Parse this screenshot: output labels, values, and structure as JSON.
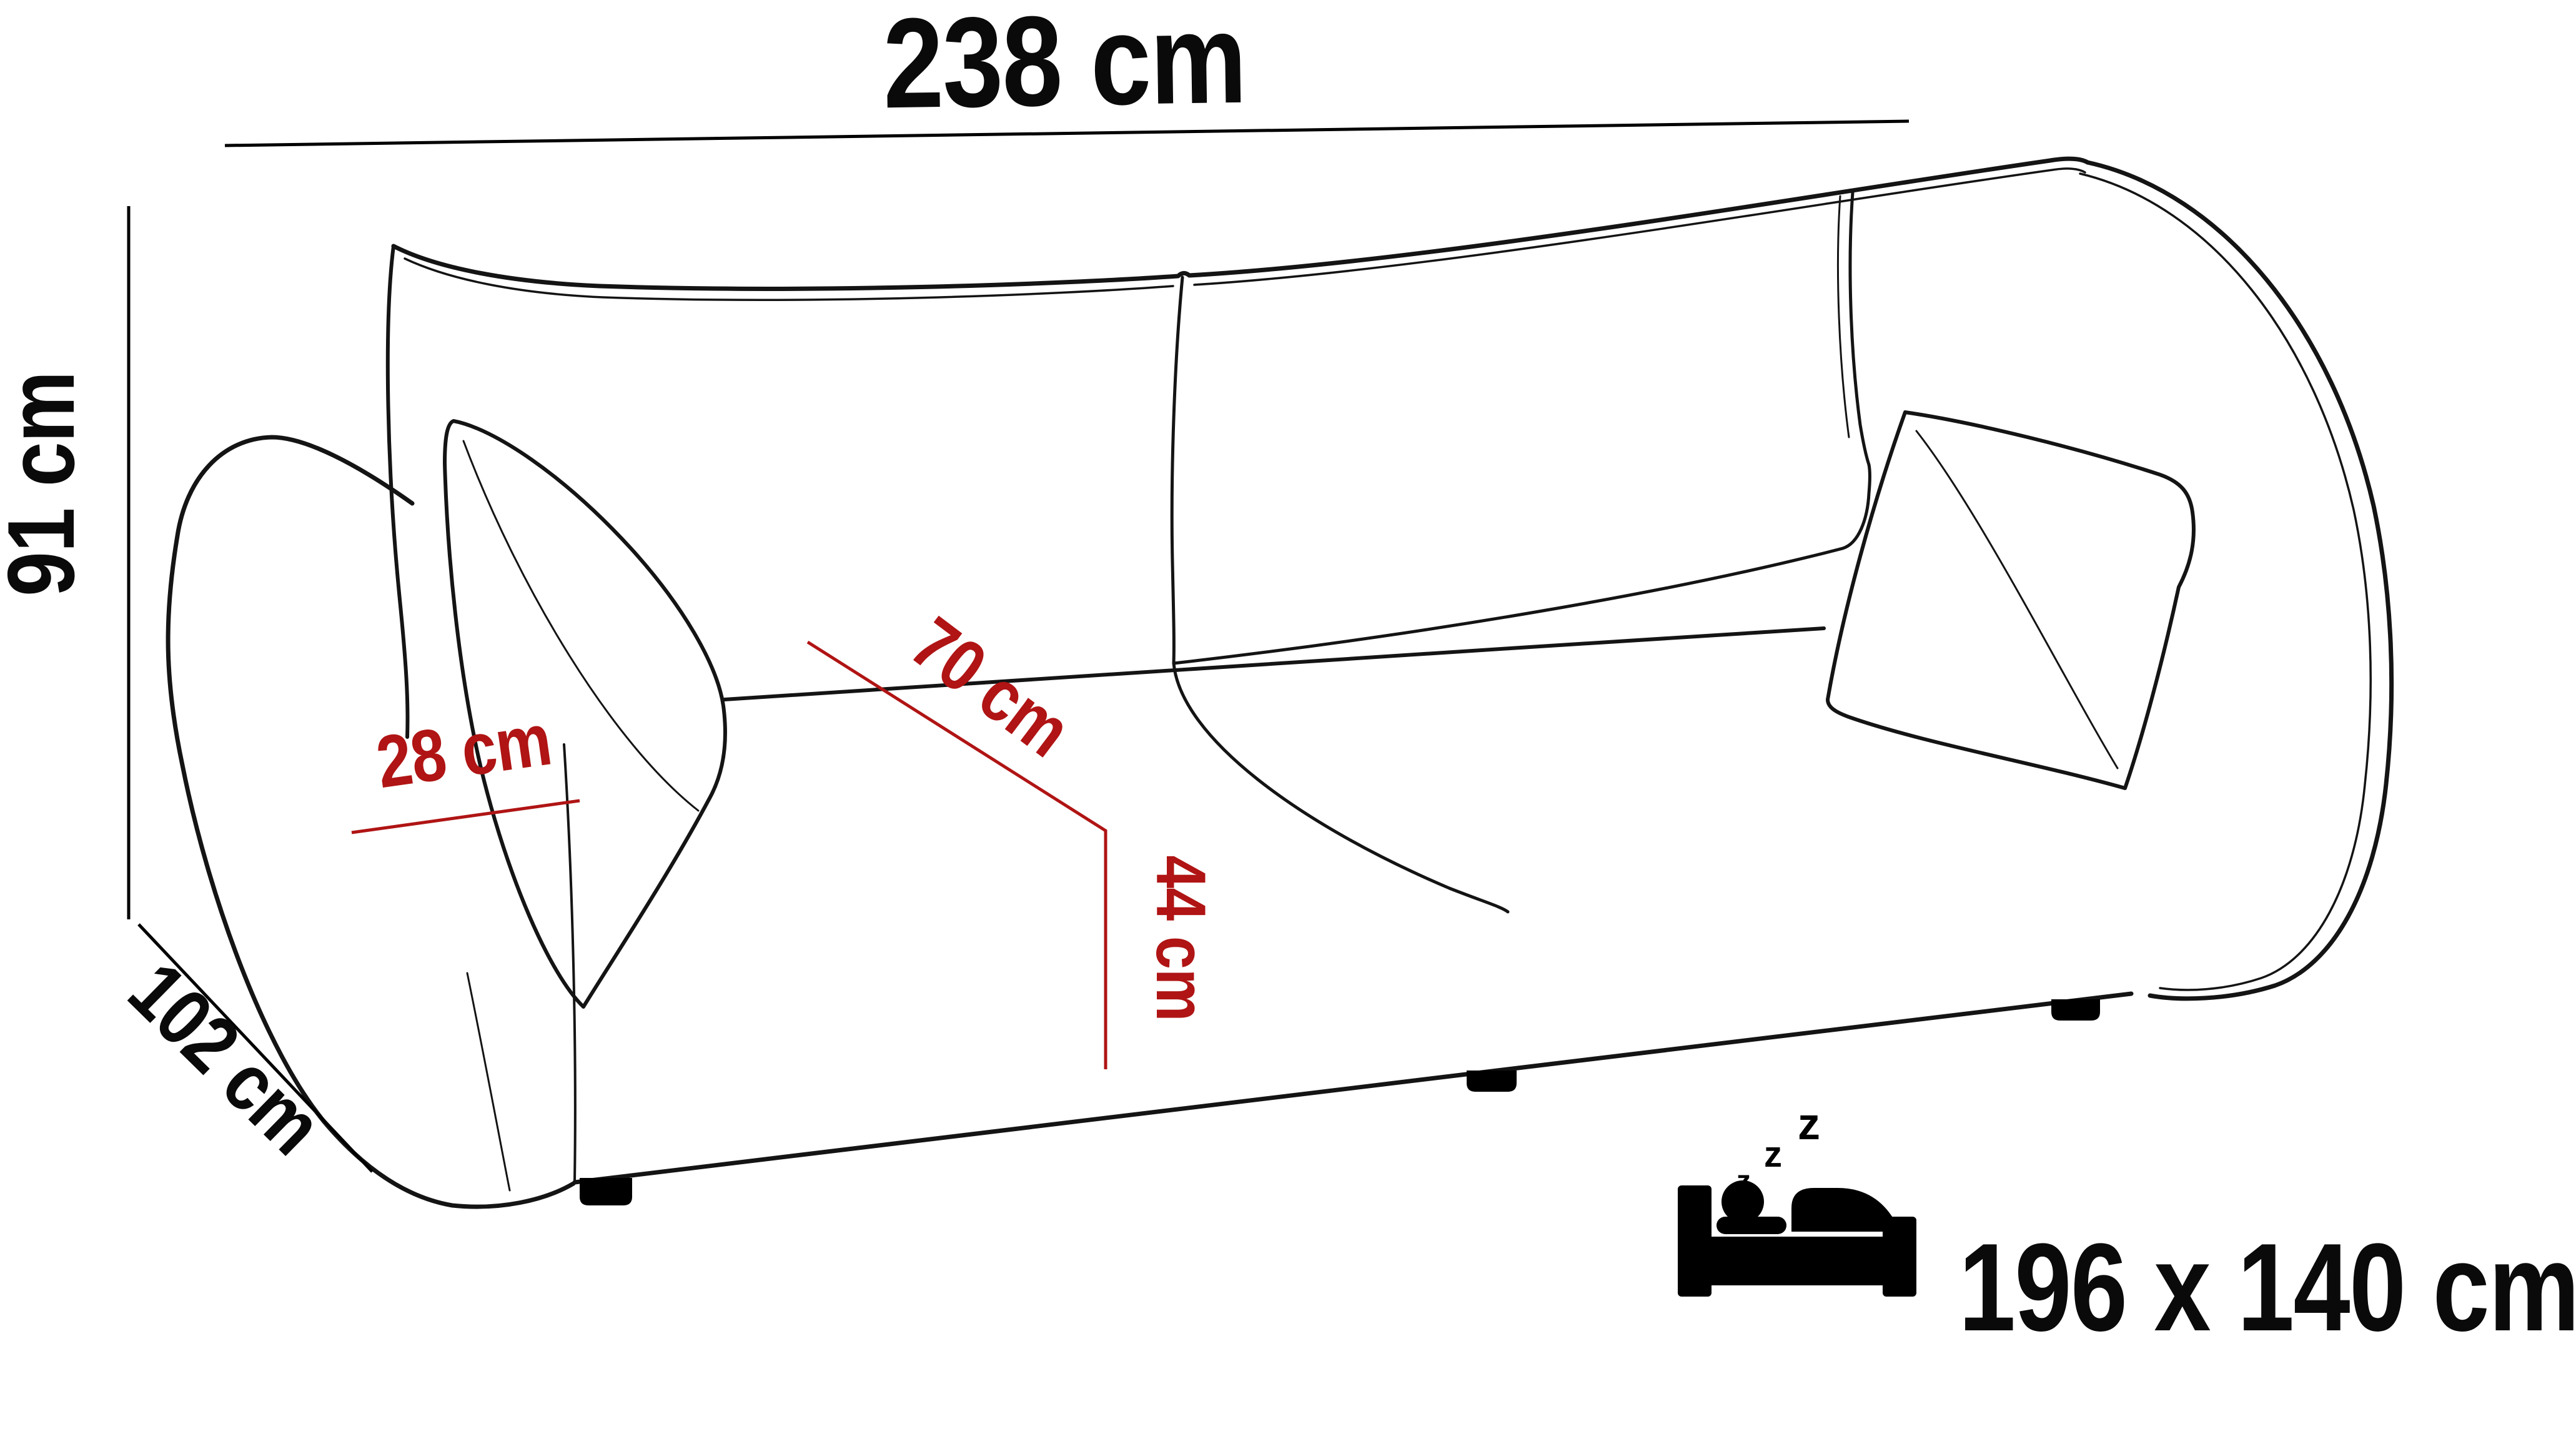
{
  "diagram": {
    "title": "sofa-dimension-diagram",
    "colors": {
      "background": "#ffffff",
      "outline": "#141414",
      "dimension_line": "#000000",
      "accent_red": "#b01414"
    },
    "dimensions": {
      "width": {
        "text": "238 cm"
      },
      "height": {
        "text": "91 cm"
      },
      "depth": {
        "text": "102 cm"
      },
      "armrest_width": {
        "text": "28 cm"
      },
      "seat_depth": {
        "text": "70 cm"
      },
      "seat_height": {
        "text": "44 cm"
      }
    },
    "sleeping_area": {
      "icon": "sleeping-person-bed-icon",
      "text": "196 x 140 cm",
      "zzz": [
        "z",
        "z",
        "z"
      ]
    }
  }
}
